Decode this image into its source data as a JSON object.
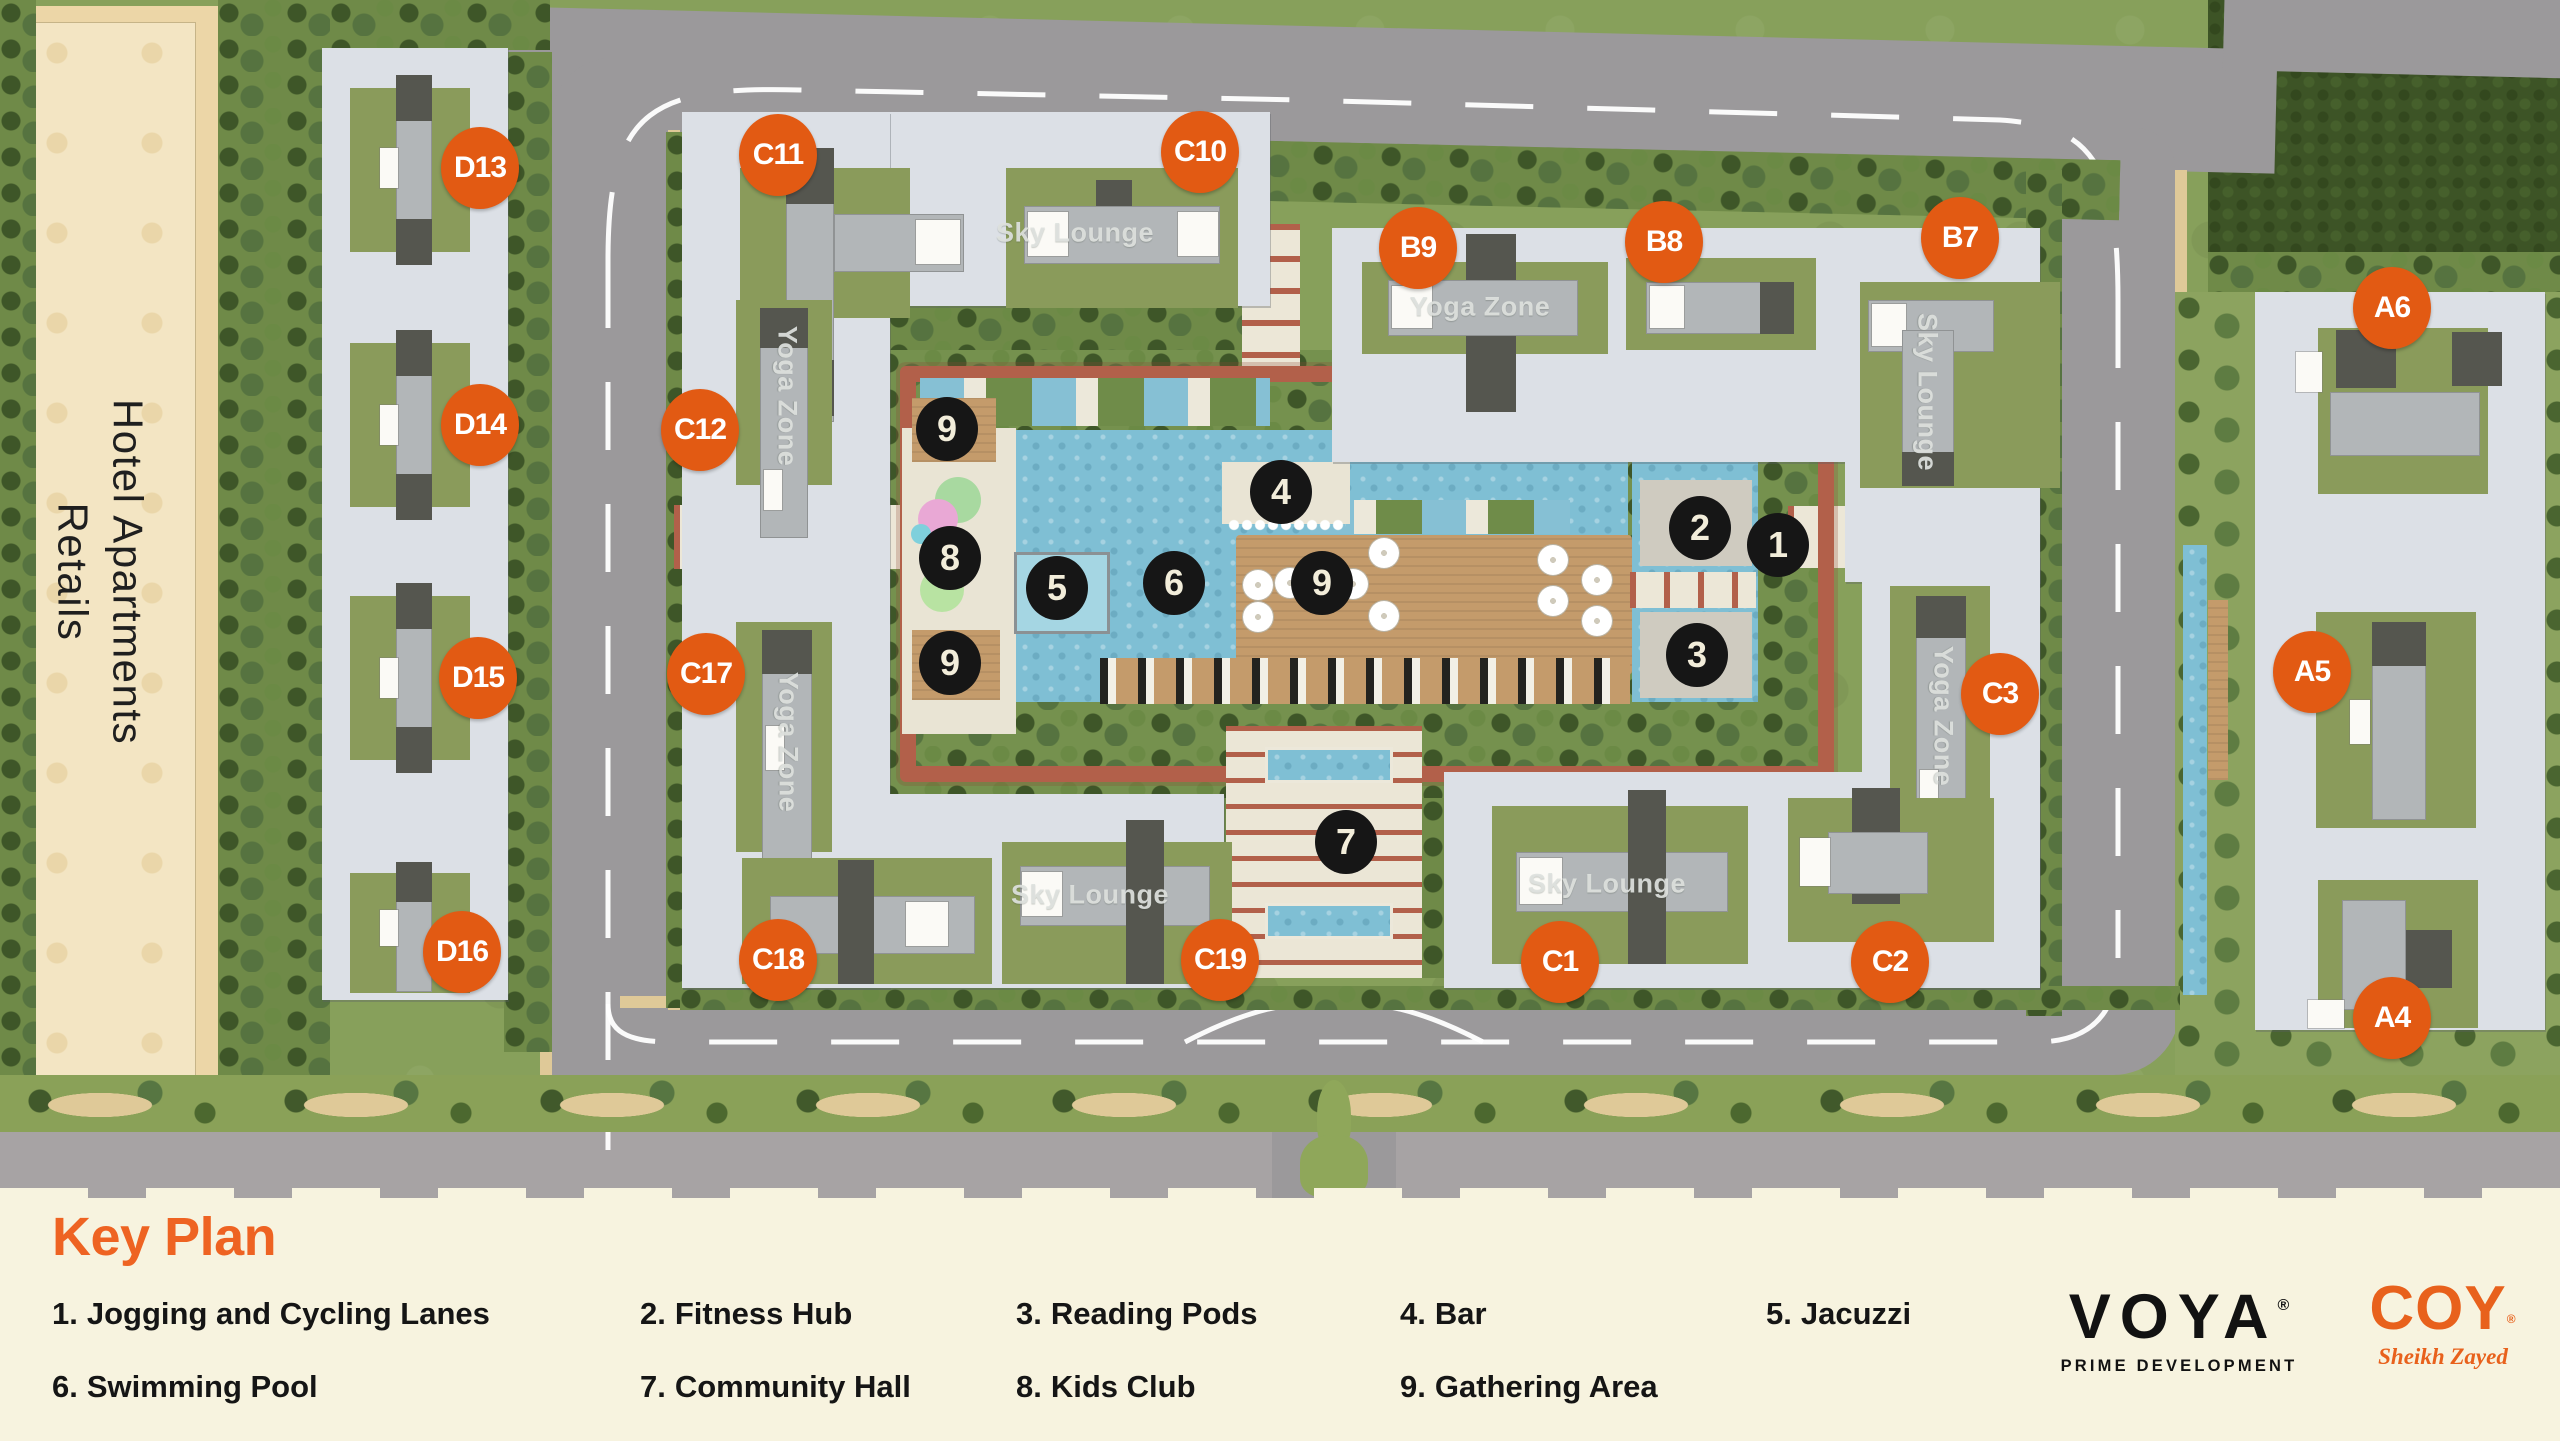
{
  "map": {
    "hotel_area": {
      "line1": "Hotel Apartments",
      "line2": "Retails"
    },
    "badges": [
      {
        "id": "D13",
        "x": 480,
        "y": 168
      },
      {
        "id": "D14",
        "x": 480,
        "y": 425
      },
      {
        "id": "D15",
        "x": 478,
        "y": 678
      },
      {
        "id": "D16",
        "x": 462,
        "y": 952
      },
      {
        "id": "C11",
        "x": 778,
        "y": 155
      },
      {
        "id": "C10",
        "x": 1200,
        "y": 152
      },
      {
        "id": "C12",
        "x": 700,
        "y": 430
      },
      {
        "id": "C17",
        "x": 706,
        "y": 674
      },
      {
        "id": "C18",
        "x": 778,
        "y": 960
      },
      {
        "id": "C19",
        "x": 1220,
        "y": 960
      },
      {
        "id": "B9",
        "x": 1418,
        "y": 248
      },
      {
        "id": "B8",
        "x": 1664,
        "y": 242
      },
      {
        "id": "B7",
        "x": 1960,
        "y": 238
      },
      {
        "id": "C3",
        "x": 2000,
        "y": 694
      },
      {
        "id": "C1",
        "x": 1560,
        "y": 962
      },
      {
        "id": "C2",
        "x": 1890,
        "y": 962
      },
      {
        "id": "A6",
        "x": 2392,
        "y": 308
      },
      {
        "id": "A5",
        "x": 2312,
        "y": 672
      },
      {
        "id": "A4",
        "x": 2392,
        "y": 1018
      }
    ],
    "markers": [
      {
        "n": "1",
        "x": 1778,
        "y": 545
      },
      {
        "n": "2",
        "x": 1700,
        "y": 528
      },
      {
        "n": "3",
        "x": 1697,
        "y": 655
      },
      {
        "n": "4",
        "x": 1281,
        "y": 492
      },
      {
        "n": "5",
        "x": 1057,
        "y": 588
      },
      {
        "n": "6",
        "x": 1174,
        "y": 583
      },
      {
        "n": "7",
        "x": 1346,
        "y": 842
      },
      {
        "n": "8",
        "x": 950,
        "y": 558
      },
      {
        "n": "9",
        "x": 947,
        "y": 429
      },
      {
        "n": "9",
        "x": 1322,
        "y": 583
      },
      {
        "n": "9",
        "x": 950,
        "y": 663
      }
    ],
    "zone_labels": [
      {
        "text": "Sky Lounge",
        "x": 1075,
        "y": 233,
        "vertical": false
      },
      {
        "text": "Yoga Zone",
        "x": 787,
        "y": 396,
        "vertical": true
      },
      {
        "text": "Yoga Zone",
        "x": 1480,
        "y": 307,
        "vertical": false
      },
      {
        "text": "Sky Lounge",
        "x": 1927,
        "y": 392,
        "vertical": true
      },
      {
        "text": "Yoga Zone",
        "x": 788,
        "y": 742,
        "vertical": true
      },
      {
        "text": "Sky Lounge",
        "x": 1090,
        "y": 895,
        "vertical": false
      },
      {
        "text": "Yoga Zone",
        "x": 1943,
        "y": 716,
        "vertical": true
      },
      {
        "text": "Sky Lounge",
        "x": 1607,
        "y": 884,
        "vertical": false
      }
    ]
  },
  "legend": {
    "title": "Key Plan",
    "items": [
      {
        "num": "1.",
        "label": "Jogging and Cycling Lanes",
        "x": 52,
        "y": 1296
      },
      {
        "num": "2.",
        "label": "Fitness Hub",
        "x": 640,
        "y": 1296
      },
      {
        "num": "3.",
        "label": "Reading Pods",
        "x": 1016,
        "y": 1296
      },
      {
        "num": "4.",
        "label": "Bar",
        "x": 1400,
        "y": 1296
      },
      {
        "num": "5.",
        "label": "Jacuzzi",
        "x": 1766,
        "y": 1296
      },
      {
        "num": "6.",
        "label": "Swimming Pool",
        "x": 52,
        "y": 1369
      },
      {
        "num": "7.",
        "label": "Community Hall",
        "x": 640,
        "y": 1369
      },
      {
        "num": "8.",
        "label": "Kids Club",
        "x": 1016,
        "y": 1369
      },
      {
        "num": "9.",
        "label": "Gathering Area",
        "x": 1400,
        "y": 1369
      }
    ]
  },
  "brand": {
    "developer_name": "VOYA",
    "developer_reg": "®",
    "developer_tagline": "PRIME DEVELOPMENT",
    "project_name": "COY",
    "project_reg": "®",
    "project_sub": "Sheikh Zayed"
  },
  "colors": {
    "badge_orange": "#E25A13",
    "accent_orange": "#EE6322",
    "coy_orange": "#E8611C",
    "marker_black": "#161616",
    "legend_cream": "#F7F3DF",
    "pool_blue": "#7FBFD4",
    "terracotta": "#B2604A",
    "slab_gray": "#DCE0E6",
    "road_gray": "#9B999B"
  }
}
